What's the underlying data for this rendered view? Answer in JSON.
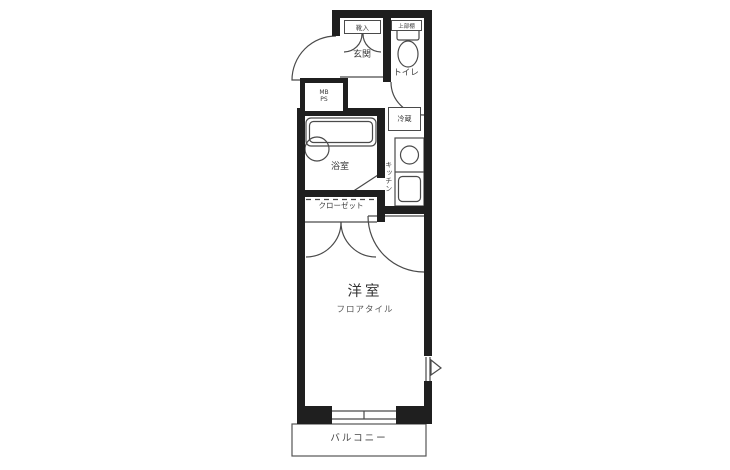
{
  "labels": {
    "shoe_cabinet": "靴入",
    "upper_shelf": "上部棚",
    "entrance": "玄関",
    "toilet": "トイレ",
    "meter_box": "MB",
    "pipe_space": "PS",
    "bathroom": "浴室",
    "closet": "クローゼット",
    "refrigerator": "冷蔵",
    "kitchen": "キッチン",
    "room": "洋室",
    "room_floor": "フロアタイル",
    "balcony": "バルコニー"
  },
  "colors": {
    "wall": "#1f1f1f",
    "fixture_line": "#4a4a4a",
    "text": "#3a3a3a",
    "background": "#ffffff"
  }
}
